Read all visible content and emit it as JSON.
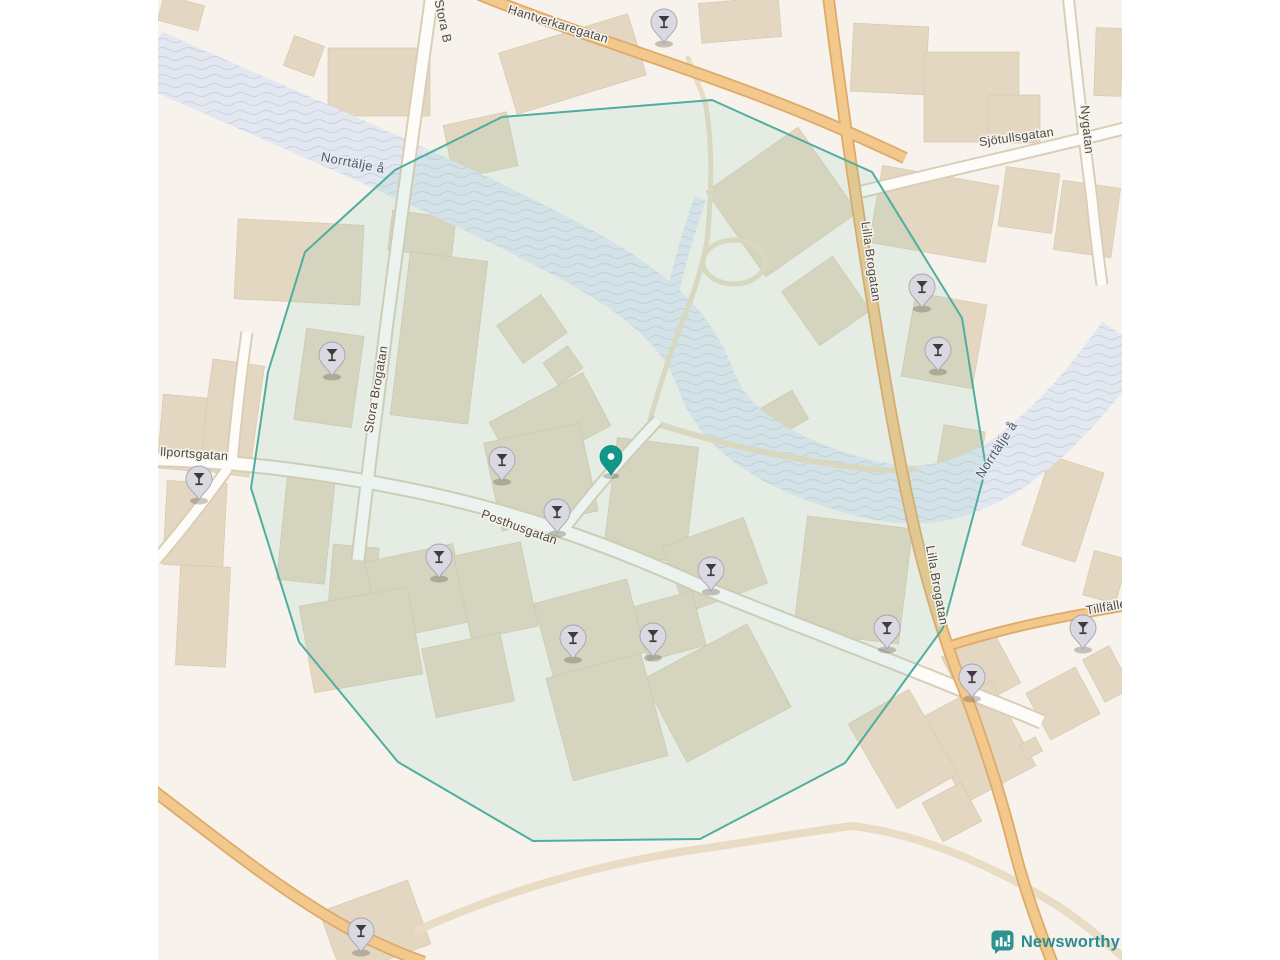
{
  "logo": {
    "text": "Newsworthy"
  },
  "colors": {
    "map_bg": "#f7f3ec",
    "margin_bg": "#ffffff",
    "building": "#e3d7c2",
    "building_stroke": "#d8c9ae",
    "river": "#e2e7f0",
    "river_wave": "#c9d3e2",
    "road_white": "#fdfcf8",
    "road_casing": "#dbceb8",
    "road_orange": "#f2c88c",
    "road_orange_casing": "#dfa968",
    "road_minor": "#e8dcc4",
    "overlay_fill": "rgba(137,201,182,0.16)",
    "overlay_stroke": "#4fae9f",
    "marker_body": "#dad8e0",
    "marker_border": "#a6a4b0",
    "marker_glyph": "#3d3b3e",
    "pin_teal": "#12988a",
    "pin_teal_dark": "#0e8679",
    "logo_teal": "#2e9390"
  },
  "map": {
    "labels": [
      {
        "text": "Hantverkaregatan",
        "x": 557,
        "y": 28,
        "rot": 17,
        "cls": "street"
      },
      {
        "text": "Stora B",
        "x": 439,
        "y": 22,
        "rot": 78,
        "cls": "street"
      },
      {
        "text": "Norrtälje å",
        "x": 352,
        "y": 167,
        "rot": 11,
        "cls": "water"
      },
      {
        "text": "Stora Brogatan",
        "x": 380,
        "y": 390,
        "rot": -80,
        "cls": "street"
      },
      {
        "text": "llportsgatan",
        "x": 194,
        "y": 458,
        "rot": 4,
        "cls": "street"
      },
      {
        "text": "Posthusgatan",
        "x": 518,
        "y": 531,
        "rot": 20,
        "cls": "street"
      },
      {
        "text": "Lilla Brogatan",
        "x": 867,
        "y": 262,
        "rot": 82,
        "cls": "street"
      },
      {
        "text": "Lilla Brogatan",
        "x": 933,
        "y": 586,
        "rot": 80,
        "cls": "street"
      },
      {
        "text": "Sjötullsgatan",
        "x": 1017,
        "y": 141,
        "rot": -8,
        "cls": "street"
      },
      {
        "text": "Nygatan",
        "x": 1083,
        "y": 130,
        "rot": 84,
        "cls": "street"
      },
      {
        "text": "Norrtälje å",
        "x": 1000,
        "y": 452,
        "rot": -57,
        "cls": "water"
      },
      {
        "text": "Tillfälle",
        "x": 1107,
        "y": 611,
        "rot": -10,
        "cls": "street"
      }
    ],
    "bar_markers": [
      [
        664,
        43
      ],
      [
        922,
        308
      ],
      [
        938,
        371
      ],
      [
        332,
        376
      ],
      [
        199,
        500
      ],
      [
        502,
        481
      ],
      [
        557,
        533
      ],
      [
        439,
        578
      ],
      [
        711,
        591
      ],
      [
        573,
        659
      ],
      [
        653,
        657
      ],
      [
        887,
        649
      ],
      [
        972,
        698
      ],
      [
        1083,
        649
      ],
      [
        361,
        952
      ]
    ],
    "center_pin": {
      "x": 611,
      "y": 475
    },
    "coverage_polygon": "502,117 712,100 872,172 962,318 986,468 943,628 845,763 700,839 533,841 398,762 299,642 251,488 268,372 305,252 395,170",
    "rivers": [
      {
        "d": "M150,58 C300,125 470,195 590,262 C650,297 688,330 706,380 C724,432 780,465 860,487 C920,503 965,492 1010,462 C1050,434 1090,390 1126,338",
        "w": 58
      },
      {
        "d": "M668,318 C676,272 688,235 700,198",
        "w": 12
      }
    ],
    "roads": {
      "minor": [
        {
          "d": "M418,930 C500,893 600,863 700,849 C755,841 805,832 852,826",
          "w": 8
        },
        {
          "d": "M852,826 C920,834 990,864 1058,906 C1088,926 1108,944 1126,960",
          "w": 8
        },
        {
          "d": "M658,424 C730,447 800,461 868,469 C888,471 902,471 914,469",
          "w": 6
        },
        {
          "d": "M650,420 C662,378 674,340 690,302 C700,274 706,252 708,232",
          "w": 5
        },
        {
          "d": "M708,232 C711,192 713,150 706,106",
          "w": 5
        },
        {
          "d": "M703,262 a31,22 0 1,0 62,0 a31,22 0 1,0 -62,0",
          "w": 5
        },
        {
          "d": "M688,58 C696,78 702,92 706,106",
          "w": 5
        }
      ],
      "white": [
        {
          "d": "M432,-6 C420,80 400,220 386,330 C378,398 370,455 358,560",
          "w": 11
        },
        {
          "d": "M152,459 C240,461 330,473 420,492 C520,513 610,545 700,586 C790,623 880,656 965,691 C995,703 1020,712 1042,722",
          "w": 12
        },
        {
          "d": "M852,194 C940,172 1040,150 1126,128",
          "w": 10
        },
        {
          "d": "M1068,-6 C1076,70 1084,140 1092,200 C1095,230 1098,255 1102,285",
          "w": 9
        },
        {
          "d": "M562,532 C590,495 625,455 658,420",
          "w": 9
        },
        {
          "d": "M232,463 C236,420 240,380 247,332",
          "w": 9
        },
        {
          "d": "M228,468 C205,500 182,530 156,560",
          "w": 9
        }
      ],
      "orange": [
        {
          "d": "M478,-6 C560,28 660,58 760,96 C805,113 850,132 905,158",
          "w": 9
        },
        {
          "d": "M828,-6 C840,90 856,200 872,300 C886,388 902,482 922,560 C936,612 950,656 963,687 C976,722 996,778 1012,840 C1022,882 1040,932 1052,962",
          "w": 9
        },
        {
          "d": "M952,645 C1010,627 1066,616 1126,606",
          "w": 7
        },
        {
          "d": "M150,788 C212,835 262,876 322,913 C356,934 392,951 424,962",
          "w": 9
        }
      ]
    },
    "buildings": [
      [
        160,
        0,
        42,
        26,
        15
      ],
      [
        288,
        40,
        32,
        32,
        20
      ],
      [
        328,
        48,
        102,
        68,
        0
      ],
      [
        505,
        32,
        135,
        64,
        -17
      ],
      [
        448,
        118,
        65,
        55,
        -12
      ],
      [
        700,
        0,
        80,
        40,
        -5
      ],
      [
        852,
        25,
        75,
        68,
        3
      ],
      [
        924,
        52,
        95,
        90,
        0
      ],
      [
        988,
        95,
        52,
        48,
        0
      ],
      [
        1095,
        28,
        27,
        68,
        2
      ],
      [
        875,
        175,
        118,
        78,
        10
      ],
      [
        908,
        298,
        72,
        85,
        10
      ],
      [
        1002,
        170,
        54,
        60,
        8
      ],
      [
        1058,
        184,
        58,
        70,
        8
      ],
      [
        236,
        222,
        126,
        80,
        3
      ],
      [
        300,
        332,
        58,
        92,
        8
      ],
      [
        205,
        362,
        52,
        112,
        8
      ],
      [
        160,
        396,
        44,
        74,
        5
      ],
      [
        165,
        482,
        60,
        84,
        3
      ],
      [
        178,
        566,
        50,
        100,
        3
      ],
      [
        726,
        150,
        112,
        104,
        -35
      ],
      [
        795,
        268,
        62,
        66,
        -35
      ],
      [
        763,
        398,
        40,
        33,
        -30
      ],
      [
        390,
        214,
        64,
        40,
        7
      ],
      [
        400,
        256,
        78,
        164,
        7
      ],
      [
        505,
        306,
        54,
        46,
        -35
      ],
      [
        548,
        352,
        30,
        27,
        -35
      ],
      [
        497,
        394,
        106,
        60,
        -28
      ],
      [
        492,
        432,
        98,
        90,
        -12
      ],
      [
        610,
        442,
        82,
        116,
        7
      ],
      [
        672,
        530,
        86,
        70,
        -20
      ],
      [
        800,
        522,
        106,
        116,
        7
      ],
      [
        542,
        590,
        96,
        76,
        -15
      ],
      [
        640,
        598,
        60,
        56,
        -15
      ],
      [
        658,
        646,
        118,
        94,
        -28
      ],
      [
        558,
        664,
        98,
        106,
        -15
      ],
      [
        330,
        546,
        46,
        76,
        5
      ],
      [
        372,
        552,
        90,
        80,
        -12
      ],
      [
        282,
        476,
        48,
        106,
        6
      ],
      [
        462,
        548,
        68,
        86,
        -12
      ],
      [
        306,
        596,
        110,
        88,
        -10
      ],
      [
        428,
        640,
        80,
        70,
        -12
      ],
      [
        940,
        428,
        42,
        44,
        10
      ],
      [
        1035,
        462,
        56,
        94,
        18
      ],
      [
        1088,
        554,
        34,
        46,
        15
      ],
      [
        952,
        640,
        58,
        60,
        -28
      ],
      [
        938,
        694,
        80,
        96,
        -28
      ],
      [
        1035,
        677,
        56,
        53,
        -28
      ],
      [
        1092,
        650,
        30,
        48,
        -28
      ],
      [
        868,
        700,
        70,
        98,
        -30
      ],
      [
        1022,
        740,
        18,
        16,
        -28
      ],
      [
        930,
        790,
        44,
        44,
        -28
      ],
      [
        328,
        894,
        94,
        68,
        -20
      ]
    ]
  }
}
